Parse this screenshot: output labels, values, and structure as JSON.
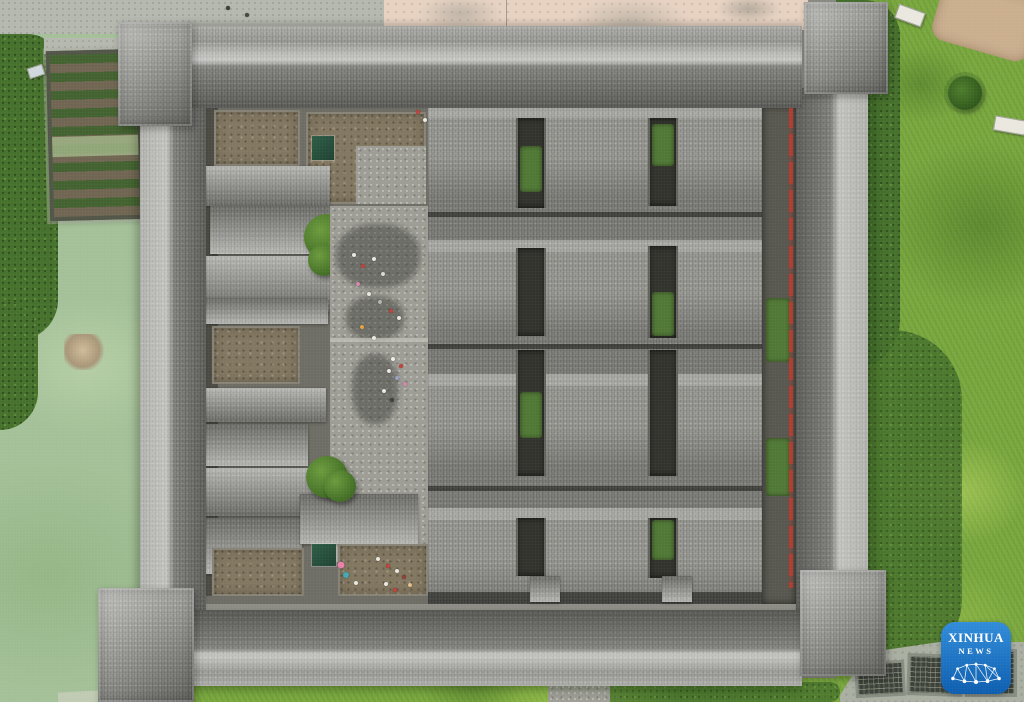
{
  "image": {
    "type": "aerial-photograph",
    "subject": "Top-down drone view of a square fortified Chinese courtyard compound with grey tiled roofs and corner towers, inner courtyards with visitors, a green pond and vegetable garden plot to the west, lawns and shrubs to the east, Xinhua News watermark at bottom right",
    "width_px": 1024,
    "height_px": 702
  },
  "watermark": {
    "line1": "XINHUA",
    "line2": "NEWS",
    "icon": "xinhua-network-bridge-icon",
    "background_top": "#2f8bd8",
    "background_bottom": "#0b5cae",
    "text_color": "#ffffff"
  },
  "palette": {
    "pond": "#a3c097",
    "grass": "#79a83d",
    "shrub": "#44702a",
    "roof": "#8e8e89",
    "stone": "#9c9c94",
    "dirt": "#81765f",
    "slot": "#31312b",
    "moss": "#4f7734",
    "red_railing": "#b23a2d",
    "pavement_pink": "#e7d2c1",
    "concrete": "#b4b7ae",
    "pavement_grey": "#a9aea1",
    "grate": "#3b3f38",
    "logo_blue_top": "#2f8bd8",
    "logo_blue_bottom": "#0b5cae"
  },
  "scene": {
    "landmarks": [
      {
        "name": "pond",
        "label": "milky-green pond with small round islet"
      },
      {
        "name": "vegetable-garden",
        "label": "rectangular raised garden bed with crop rows"
      },
      {
        "name": "fortress",
        "label": "square walled compound with four corner towers"
      },
      {
        "name": "hall-roofs",
        "label": "grid of grey tiled hall roofs with narrow courtyard slots"
      },
      {
        "name": "stone-courtyard",
        "label": "central stone-paved courtyard with trees and visitors"
      },
      {
        "name": "lawn",
        "label": "mottled green lawn east of the compound"
      },
      {
        "name": "red-railing",
        "label": "red railing line along inner east walkway"
      }
    ],
    "people": [
      {
        "x": 228,
        "y": 8,
        "color": "#3a3a35"
      },
      {
        "x": 247,
        "y": 15,
        "color": "#44443e"
      },
      {
        "x": 418,
        "y": 112,
        "color": "#c04038"
      },
      {
        "x": 425,
        "y": 120,
        "color": "#e9e9e2"
      },
      {
        "x": 354,
        "y": 255,
        "color": "#e9e9e2"
      },
      {
        "x": 363,
        "y": 266,
        "color": "#c04038"
      },
      {
        "x": 374,
        "y": 259,
        "color": "#e9e9e2"
      },
      {
        "x": 383,
        "y": 274,
        "color": "#dadad2"
      },
      {
        "x": 358,
        "y": 284,
        "color": "#d886ac"
      },
      {
        "x": 369,
        "y": 294,
        "color": "#e9e9e2"
      },
      {
        "x": 380,
        "y": 302,
        "color": "#b5b5ad"
      },
      {
        "x": 391,
        "y": 311,
        "color": "#c04038"
      },
      {
        "x": 399,
        "y": 318,
        "color": "#e9e9e2"
      },
      {
        "x": 362,
        "y": 327,
        "color": "#e2a33f"
      },
      {
        "x": 374,
        "y": 338,
        "color": "#e9e9e2"
      },
      {
        "x": 393,
        "y": 359,
        "color": "#f0f0ea"
      },
      {
        "x": 401,
        "y": 366,
        "color": "#c04038"
      },
      {
        "x": 389,
        "y": 371,
        "color": "#e9e9e2"
      },
      {
        "x": 397,
        "y": 378,
        "color": "#98a0c6"
      },
      {
        "x": 405,
        "y": 384,
        "color": "#d886ac"
      },
      {
        "x": 384,
        "y": 391,
        "color": "#e9e9e2"
      },
      {
        "x": 392,
        "y": 400,
        "color": "#3f3f3a"
      },
      {
        "x": 341,
        "y": 565,
        "color": "#e87fa6",
        "size": 7
      },
      {
        "x": 346,
        "y": 575,
        "color": "#3fa9b4",
        "size": 6
      },
      {
        "x": 356,
        "y": 583,
        "color": "#e9e9e2"
      },
      {
        "x": 378,
        "y": 559,
        "color": "#e9e9e2"
      },
      {
        "x": 388,
        "y": 566,
        "color": "#c04038"
      },
      {
        "x": 397,
        "y": 571,
        "color": "#e9e9e2"
      },
      {
        "x": 404,
        "y": 577,
        "color": "#8a3f35"
      },
      {
        "x": 386,
        "y": 584,
        "color": "#e9e9e2"
      },
      {
        "x": 395,
        "y": 590,
        "color": "#c04038"
      },
      {
        "x": 410,
        "y": 585,
        "color": "#e0c08a"
      }
    ]
  }
}
